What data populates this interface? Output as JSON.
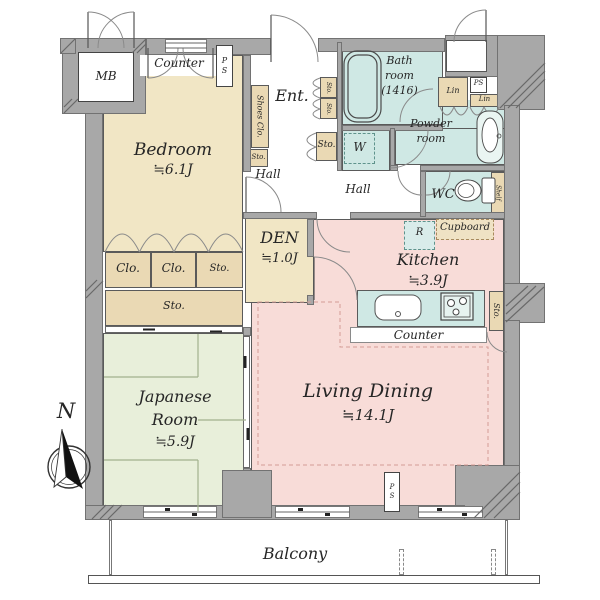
{
  "palette": {
    "wall": "#a8a8a8",
    "wall-edge": "#4d4d4d",
    "cream": "#f1e6c5",
    "tan": "#ead9b4",
    "green": "#e8efda",
    "pink": "#f8dcd8",
    "teal": "#cfe8e4",
    "line": "#444444",
    "dash-pink": "#d49c96",
    "tatami": "#a2b18e"
  },
  "rooms": {
    "bedroom": {
      "name": "Bedroom",
      "size": "≒6.1J"
    },
    "japanese": {
      "line1": "Japanese",
      "line2": "Room",
      "size": "≒5.9J"
    },
    "living": {
      "name": "Living Dining",
      "size": "≒14.1J"
    },
    "kitchen": {
      "name": "Kitchen",
      "size": "≒3.9J"
    },
    "den": {
      "name": "DEN",
      "size": "≒1.0J"
    },
    "bath": {
      "line1": "Bath",
      "line2": "room",
      "line3": "(1416)"
    },
    "powder": {
      "line1": "Powder",
      "line2": "room"
    },
    "wc": {
      "name": "WC"
    },
    "entrance": {
      "name": "Ent."
    },
    "hall_upper": {
      "name": "Hall"
    },
    "hall_lower": {
      "name": "Hall"
    },
    "balcony": {
      "name": "Balcony"
    }
  },
  "fixtures": {
    "mb": "MB",
    "counter_top": "Counter",
    "counter_kitchen": "Counter",
    "ps_top": "PS",
    "ps_upper_right": "PS",
    "ps_bottom": "PS",
    "shoes_closet": "Shoes Clo.",
    "sto_shoes": "Sto.",
    "sto_ent_upper": "Sto.",
    "sto_ent_lower": "Sto.",
    "sto_ent_hall": "Sto.",
    "clo_left": "Clo.",
    "clo_right": "Clo.",
    "sto_closet_row": "Sto.",
    "sto_big": "Sto.",
    "sto_kitchen": "Sto.",
    "lin_left": "Lin",
    "lin_right": "Lin",
    "shelf": "Shelf",
    "washer": "W",
    "fridge": "R",
    "cupboard": "Cupboard"
  },
  "compass": {
    "north": "N"
  }
}
